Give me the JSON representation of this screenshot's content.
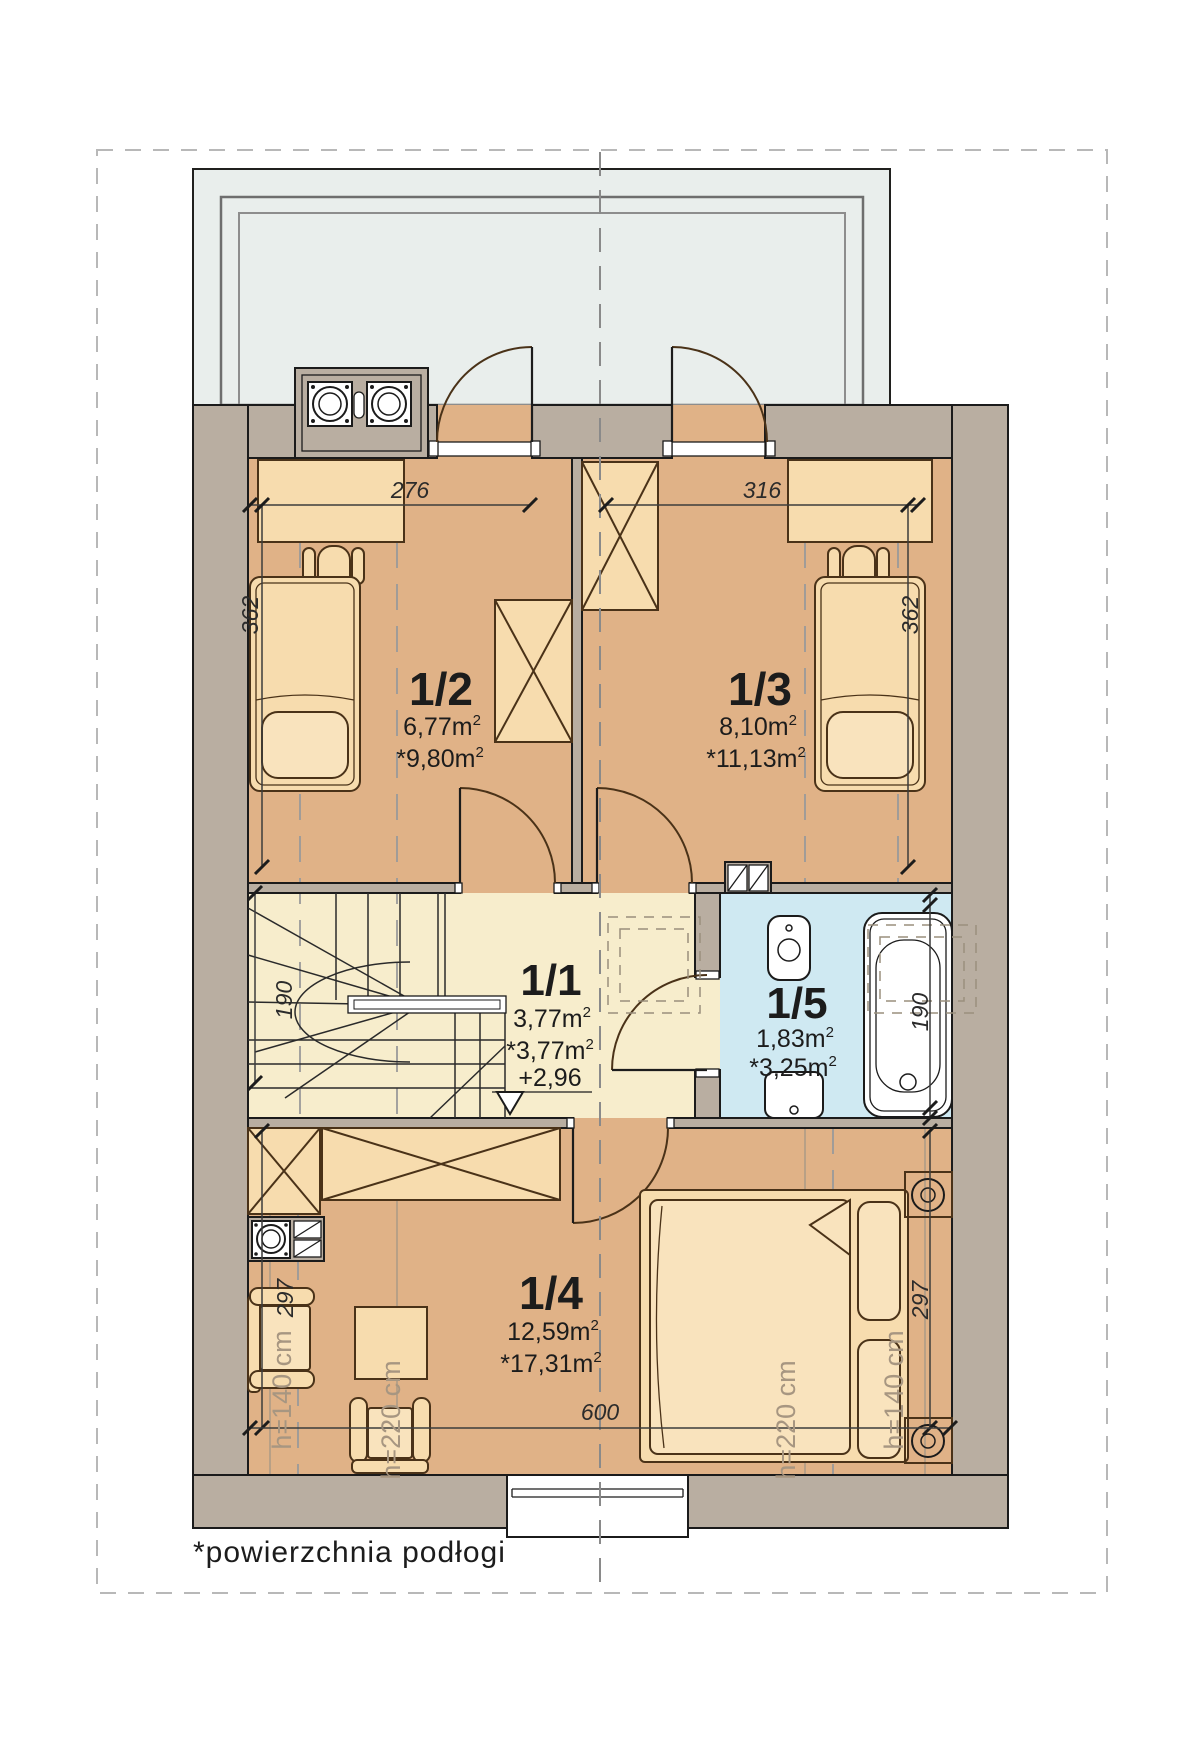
{
  "plan": {
    "title_note": "*powierzchnia podłogi",
    "sup": "2",
    "rooms": {
      "r11": {
        "id": "1/1",
        "area": "3,77m",
        "star": "*3,77m",
        "level": "+2,96"
      },
      "r12": {
        "id": "1/2",
        "area": "6,77m",
        "star": "*9,80m"
      },
      "r13": {
        "id": "1/3",
        "area": "8,10m",
        "star": "*11,13m"
      },
      "r14": {
        "id": "1/4",
        "area": "12,59m",
        "star": "*17,31m"
      },
      "r15": {
        "id": "1/5",
        "area": "1,83m",
        "star": "*3,25m"
      }
    },
    "dims": {
      "d276": "276",
      "d316": "316",
      "d362": "362",
      "d190": "190",
      "d297": "297",
      "d600": "600"
    },
    "heights": {
      "h140": "h=140 cm",
      "h220": "h=220 cm"
    },
    "colors": {
      "floor": "#e0b287",
      "hall": "#f7edcc",
      "bath": "#cfe9f2",
      "terrace": "#e9eeec",
      "wall": "#b9aea1",
      "furniture": "#f7dcae",
      "furniture_light": "#f9e3bd",
      "accent_text": "#a79681"
    }
  }
}
